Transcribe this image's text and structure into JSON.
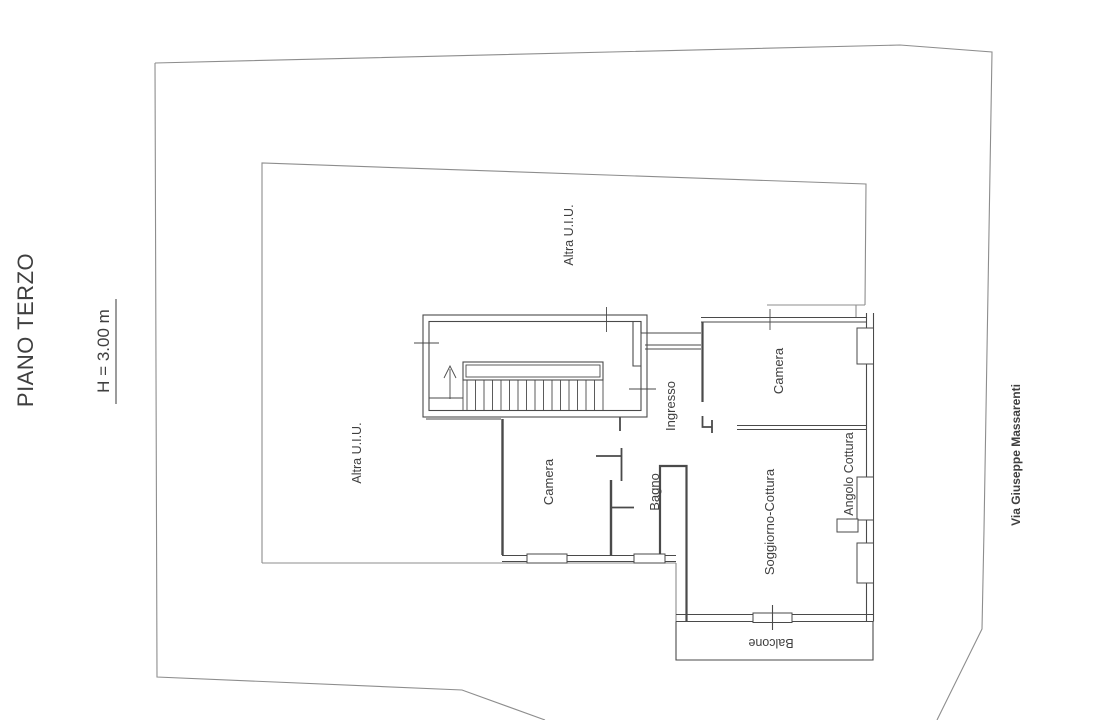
{
  "drawing": {
    "title": "PIANO TERZO",
    "height_note": "H = 3.00 m",
    "street_label": "Via Giuseppe Massarenti",
    "labels": {
      "altra_uiu_top": "Altra U.I.U.",
      "altra_uiu_left": "Altra U.I.U.",
      "camera_top_right": "Camera",
      "ingresso": "Ingresso",
      "camera_middle": "Camera",
      "bagno": "Bagno",
      "soggiorno_cottura": "Soggiorno-Cottura",
      "angolo_cottura": "Angolo Cottura",
      "balcone": "Balcone"
    },
    "colors": {
      "background": "#ffffff",
      "boundary_line": "#8d8d8d",
      "wall_line": "#4a4a4a",
      "text": "#3f3f3f"
    }
  }
}
